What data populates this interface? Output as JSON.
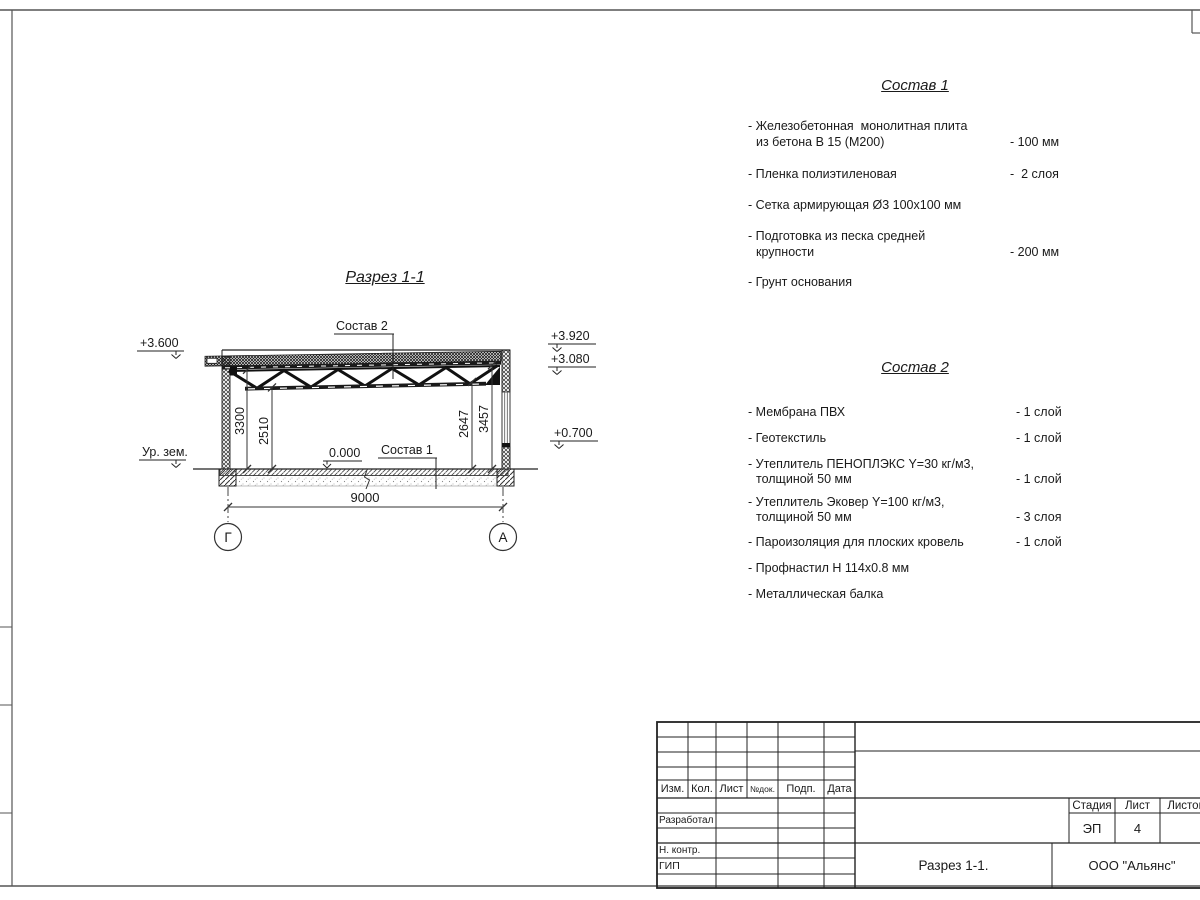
{
  "section": {
    "title": "Разрез 1-1",
    "labels": {
      "sostav2_ref": "Состав 2",
      "sostav1_ref": "Состав 1",
      "zero": "0.000",
      "ground": "Ур. зем."
    },
    "elevations": {
      "left_roof": "+3.600",
      "parapet": "+3.920",
      "roof_bottom": "+3.080",
      "right_low": "+0.700"
    },
    "dims": {
      "span": "9000",
      "h_left_clear": "3300",
      "h_left_chord": "2510",
      "h_right_chord": "2647",
      "h_right_clear": "3457"
    },
    "axes": {
      "left": "Г",
      "right": "А"
    }
  },
  "sostav1": {
    "title": "Состав 1",
    "items": [
      {
        "line1": "- Железобетонная  монолитная плита",
        "line2": "из бетона В 15 (М200)",
        "value": "- 100 мм"
      },
      {
        "line1": "- Пленка полиэтиленовая",
        "line2": "",
        "value": "-  2 слоя"
      },
      {
        "line1": "- Сетка армирующая Ø3 100х100 мм",
        "line2": "",
        "value": ""
      },
      {
        "line1": "- Подготовка из песка средней",
        "line2": "крупности",
        "value": "- 200 мм"
      },
      {
        "line1": "- Грунт основания",
        "line2": "",
        "value": ""
      }
    ]
  },
  "sostav2": {
    "title": "Состав 2",
    "items": [
      {
        "line1": "- Мембрана ПВХ",
        "line2": "",
        "value": "- 1 слой"
      },
      {
        "line1": "- Геотекстиль",
        "line2": "",
        "value": "- 1 слой"
      },
      {
        "line1": "- Утеплитель ПЕНОПЛЭКС Y=30 кг/м3,",
        "line2": "толщиной 50 мм",
        "value": "- 1 слой"
      },
      {
        "line1": "- Утеплитель Эковер Y=100 кг/м3,",
        "line2": "толщиной 50 мм",
        "value": "- 3 слоя"
      },
      {
        "line1": "- Пароизоляция для плоских кровель",
        "line2": "",
        "value": "- 1 слой"
      },
      {
        "line1": "- Профнастил Н 114х0.8 мм",
        "line2": "",
        "value": ""
      },
      {
        "line1": "- Металлическая балка",
        "line2": "",
        "value": ""
      }
    ]
  },
  "titleblock": {
    "col_izm": "Изм.",
    "col_kol": "Кол.",
    "col_list": "Лист",
    "col_ndok": "№док.",
    "col_podp": "Подп.",
    "col_data": "Дата",
    "row_razrabotal": "Разработал",
    "row_nkontr": "Н. контр.",
    "row_gip": "ГИП",
    "stage_label": "Стадия",
    "sheet_label": "Лист",
    "sheets_label": "Листов",
    "stage": "ЭП",
    "sheet_no": "4",
    "doc_title": "Разрез 1-1.",
    "company": "ООО \"Альянс\""
  }
}
